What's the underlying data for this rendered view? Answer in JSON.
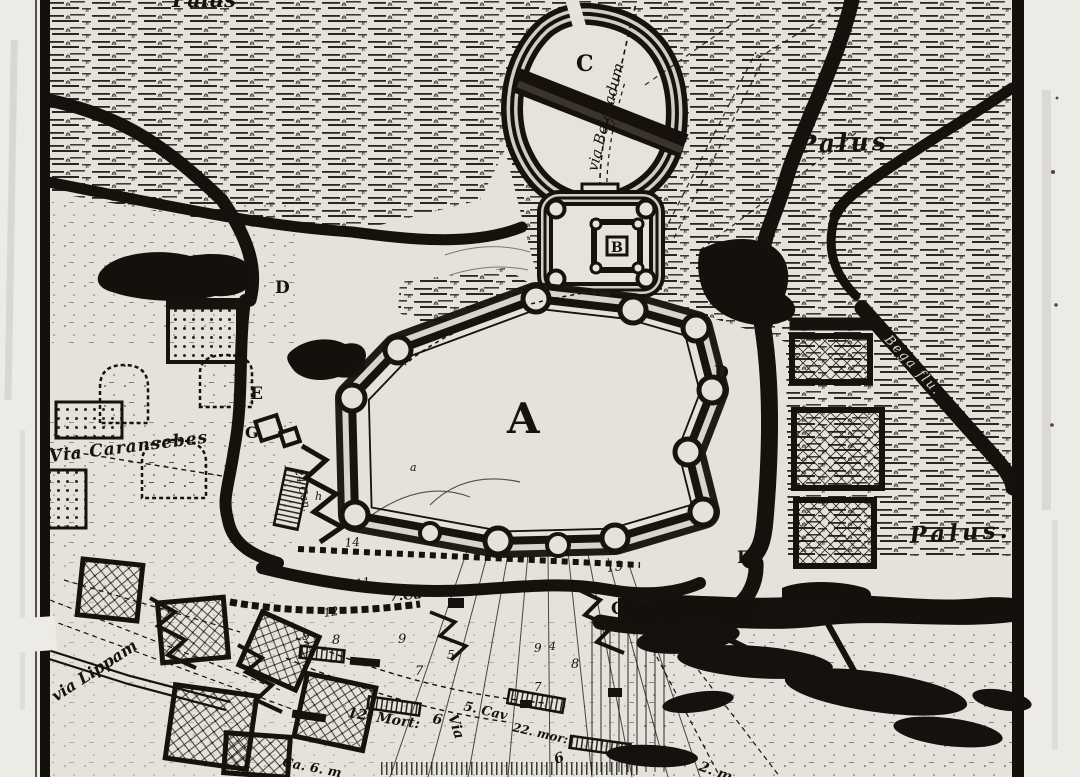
{
  "map": {
    "type": "antique-engraved-siege-map",
    "colors": {
      "paper": "#e6e4dd",
      "ink": "#16120e",
      "margin": "#edebe6",
      "light_band": "#d6d4cc"
    },
    "labels": {
      "palus_top": "Palus",
      "palus_ne": "Palus",
      "palus_se": "Palus.",
      "via_belgradum": "via Belgradum",
      "via_caransebes": "Via Caransebes",
      "via_lippam": "via Lippam",
      "via_road": "Via",
      "bega": "Bega flu.",
      "key": {
        "a": "A",
        "b": "B",
        "c": "C",
        "d": "D",
        "e": "E",
        "g": "G"
      },
      "ann": {
        "n14": "14",
        "n13": "13",
        "n11a": "11",
        "n11b": "11",
        "n7ca": "7.Ca",
        "n12": "12",
        "n9a": "9",
        "n8a": "8",
        "n9b": "9",
        "n5": "5",
        "n7a": "7",
        "n9c": "9",
        "n4": "4",
        "n8b": "8",
        "n7b": "7",
        "n6a": "6",
        "n6b": "6",
        "n2m": "2. m",
        "mort12": "12. Mort:",
        "cav5": "5. Cav",
        "mor22": "22. mor:",
        "ca6m": "Ca. 6. m",
        "can24": "24 Can.",
        "a_small": "a",
        "h_small": "h"
      }
    }
  }
}
